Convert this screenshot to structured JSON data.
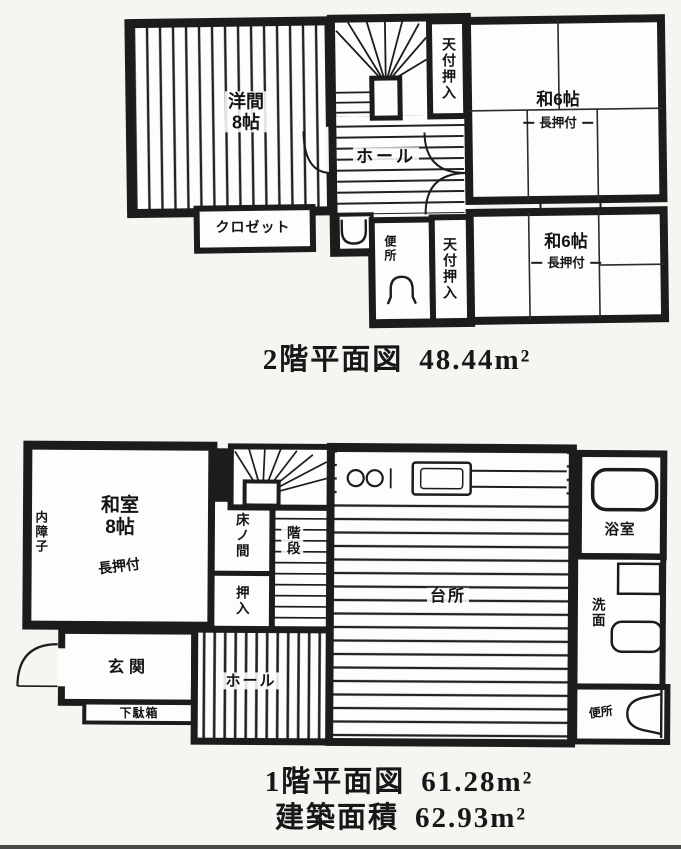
{
  "palette": {
    "paper": "#f6f5f1",
    "floor": "#fdfdfb",
    "ink": "#1c1c1c"
  },
  "floor2": {
    "caption": {
      "title": "2階平面図",
      "area": "48.44m²"
    },
    "labels": {
      "western_room_name": "洋間",
      "western_room_size": "8帖",
      "closet": "クロゼット",
      "ceiling_closet_top": "天付押入",
      "hall": "ホール",
      "tatami_room_a_name": "和6帖",
      "tatami_room_a_sub": "長押付",
      "toilet": "便所",
      "ceiling_closet_bottom": "天付押入",
      "tatami_room_b_name": "和6帖",
      "tatami_room_b_sub": "長押付"
    }
  },
  "floor1": {
    "caption": {
      "title": "1階平面図",
      "area": "61.28m²"
    },
    "building_area": {
      "title": "建築面積",
      "area": "62.93m²"
    },
    "labels": {
      "tatami_room_name": "和室",
      "tatami_room_size": "8帖",
      "tatami_room_sub": "長押付",
      "inner_shoji": "内障子",
      "tokonoma": "床ノ間",
      "stairs": "階段",
      "closet": "押入",
      "entrance": "玄関",
      "shoe_cabinet": "下駄箱",
      "hall": "ホール",
      "kitchen": "台所",
      "bathroom": "浴室",
      "washroom": "洗面",
      "toilet": "便所"
    }
  }
}
